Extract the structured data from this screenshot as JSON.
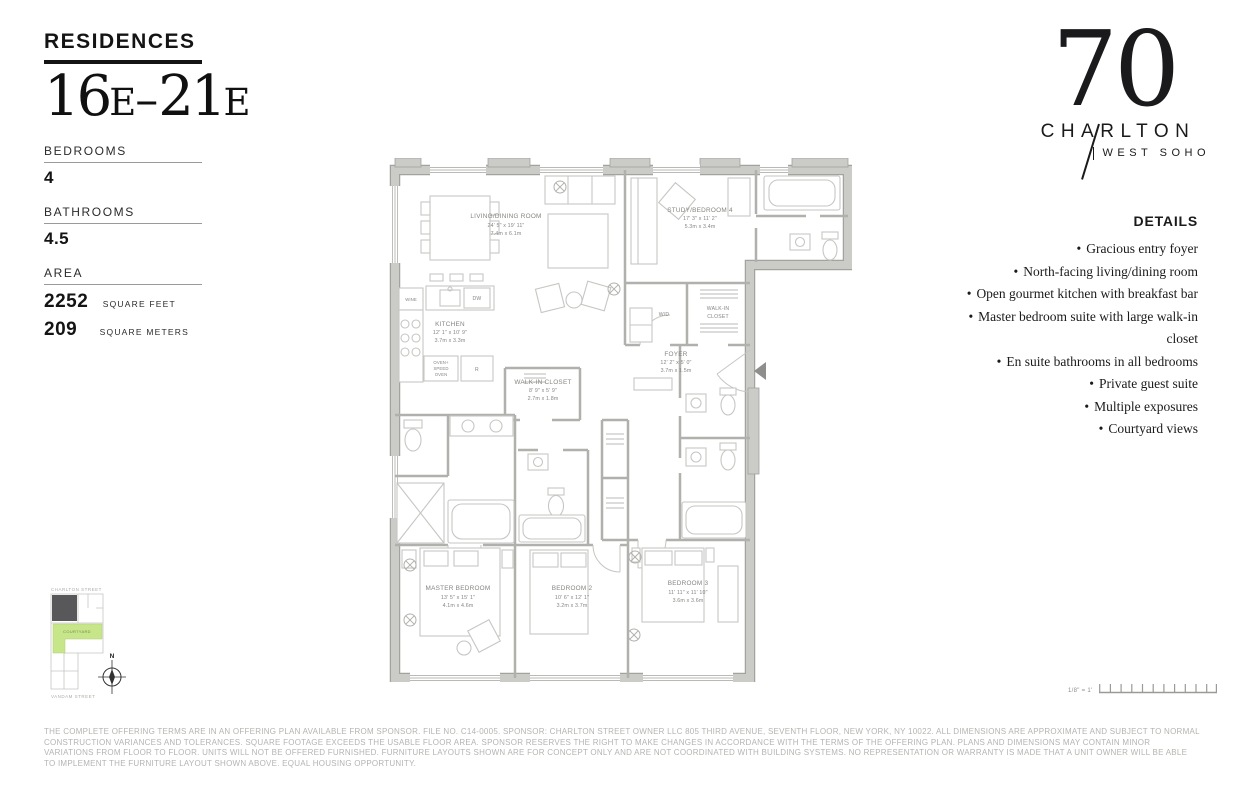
{
  "sidebar": {
    "residences_label": "RESIDENCES",
    "unit_range": {
      "part1": "16",
      "part2": "E",
      "part3": "–",
      "part4": "21",
      "part5": "E"
    },
    "bedrooms_label": "BEDROOMS",
    "bedrooms_value": "4",
    "bathrooms_label": "BATHROOMS",
    "bathrooms_value": "4.5",
    "area_label": "AREA",
    "area_sqft_value": "2252",
    "area_sqft_unit": "SQUARE FEET",
    "area_sqm_value": "209",
    "area_sqm_unit": "SQUARE METERS"
  },
  "logo": {
    "number": "70",
    "name": "CHARLTON",
    "tagline": "WEST SOHO"
  },
  "details": {
    "title": "DETAILS",
    "bullet": "•",
    "items": [
      "Gracious entry foyer",
      "North-facing living/dining room",
      "Open gourmet kitchen with breakfast bar",
      "Master bedroom suite with large walk-in closet",
      "En suite bathrooms in all bedrooms",
      "Private guest suite",
      "Multiple exposures",
      "Courtyard views"
    ]
  },
  "floorplan": {
    "rooms": [
      {
        "name": "LIVING/DINING ROOM",
        "imperial": "24' 5\" x 19' 11\"",
        "metric": "7.4m x 6.1m"
      },
      {
        "name": "KITCHEN",
        "imperial": "12' 1\" x 10' 9\"",
        "metric": "3.7m x 3.3m"
      },
      {
        "name": "STUDY/BEDROOM 4",
        "imperial": "17' 3\" x 11' 2\"",
        "metric": "5.3m x 3.4m"
      },
      {
        "name": "FOYER",
        "imperial": "12' 2\" x 5' 0\"",
        "metric": "3.7m x 1.5m"
      },
      {
        "name": "WALK-IN CLOSET",
        "imperial": "8' 9\" x 5' 9\"",
        "metric": "2.7m x 1.8m"
      },
      {
        "name": "MASTER BEDROOM",
        "imperial": "13' 5\" x 15' 1\"",
        "metric": "4.1m x 4.6m"
      },
      {
        "name": "BEDROOM 2",
        "imperial": "10' 6\" x 12' 1\"",
        "metric": "3.2m x 3.7m"
      },
      {
        "name": "BEDROOM 3",
        "imperial": "11' 11\" x 11' 10\"",
        "metric": "3.6m x 3.6m"
      }
    ],
    "appliances": {
      "wine": "WINE",
      "dw": "DW",
      "oven_line1": "OVEN+",
      "oven_line2": "SPEED",
      "oven_line3": "OVEN",
      "refrigerator": "R",
      "wd": "W/D",
      "closet_line1": "WALK-IN",
      "closet_line2": "CLOSET"
    }
  },
  "site_plan": {
    "street_top": "CHARLTON STREET",
    "street_bottom": "VANDAM STREET",
    "courtyard_label": "COURTYARD",
    "compass_label": "N",
    "unit_fill": "#58585A",
    "courtyard_fill": "#C7E689"
  },
  "scale_bar": {
    "label": "1/8\" = 1'"
  },
  "colors": {
    "wall": "#CBCBC7",
    "wall_edge": "#A2A29E",
    "interior_line": "#B0B0AC",
    "text_dark": "#141414",
    "plan_text": "#85858.0"
  },
  "disclaimer": "THE COMPLETE OFFERING TERMS ARE IN AN OFFERING PLAN AVAILABLE FROM SPONSOR. FILE NO. C14-0005. SPONSOR: CHARLTON STREET OWNER LLC 805 THIRD AVENUE, SEVENTH FLOOR, NEW YORK, NY 10022. ALL DIMENSIONS ARE APPROXIMATE AND SUBJECT TO NORMAL CONSTRUCTION VARIANCES AND TOLERANCES. SQUARE FOOTAGE EXCEEDS THE USABLE FLOOR AREA. SPONSOR RESERVES THE RIGHT TO MAKE CHANGES IN ACCORDANCE WITH THE TERMS OF THE OFFERING PLAN. PLANS AND DIMENSIONS MAY CONTAIN MINOR VARIATIONS FROM FLOOR TO FLOOR. UNITS WILL NOT BE OFFERED FURNISHED. FURNITURE LAYOUTS SHOWN ARE FOR CONCEPT ONLY AND ARE NOT COORDINATED WITH BUILDING SYSTEMS. NO REPRESENTATION OR WARRANTY IS MADE THAT A UNIT OWNER WILL BE ABLE TO IMPLEMENT THE FURNITURE LAYOUT SHOWN ABOVE. EQUAL HOUSING OPPORTUNITY."
}
